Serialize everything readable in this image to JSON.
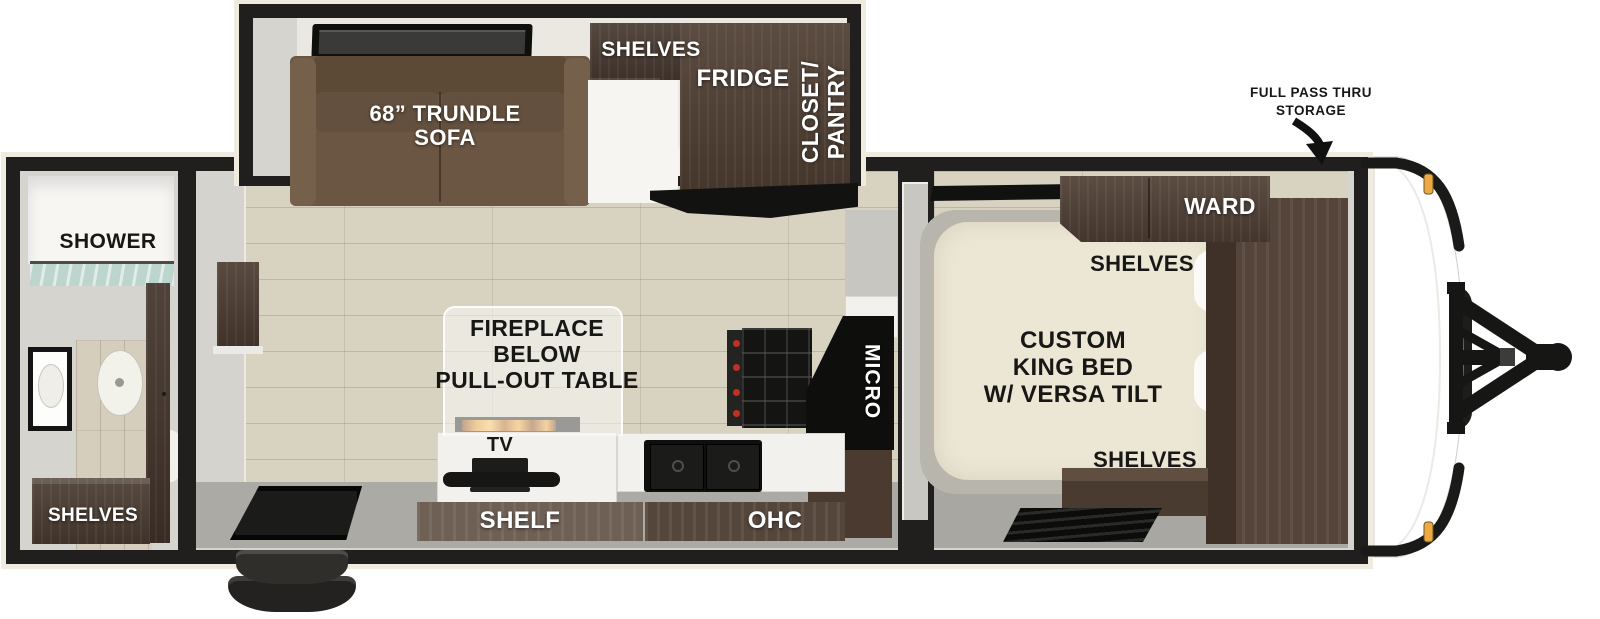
{
  "title": "Travel trailer floor plan",
  "colors": {
    "wall": "#1f1e1c",
    "trim": "#efecdf",
    "wood_floor": "#d8d2c1",
    "gray_floor": "#a9a7a1",
    "dark_cabinet": "#4a3a2f",
    "sofa_brown": "#6b5543",
    "bed_cream": "#ece7d5",
    "counter_white": "#f2f1ed",
    "flame_orange": "#e8922a",
    "marker_light_amber": "#edaa42"
  },
  "sections": {
    "bathroom": {
      "shower": "SHOWER",
      "shelves": "SHELVES"
    },
    "living": {
      "sofa_lines": [
        "68” TRUNDLE",
        "SOFA"
      ],
      "shelves": "SHELVES",
      "fridge": "FRIDGE",
      "closet_lines": [
        "CLOSET/",
        "PANTRY"
      ],
      "table_lines": [
        "FIREPLACE",
        "BELOW",
        "PULL-OUT TABLE"
      ],
      "tv": "TV",
      "shelf": "SHELF",
      "ohc": "OHC",
      "micro": "MICRO"
    },
    "bedroom": {
      "ward": "WARD",
      "shelves_top": "SHELVES",
      "bed_lines": [
        "CUSTOM",
        "KING BED",
        "W/ VERSA TILT"
      ],
      "shelves_bottom": "SHELVES"
    },
    "exterior": {
      "pass_thru_lines": [
        "FULL PASS THRU",
        "STORAGE"
      ]
    }
  }
}
